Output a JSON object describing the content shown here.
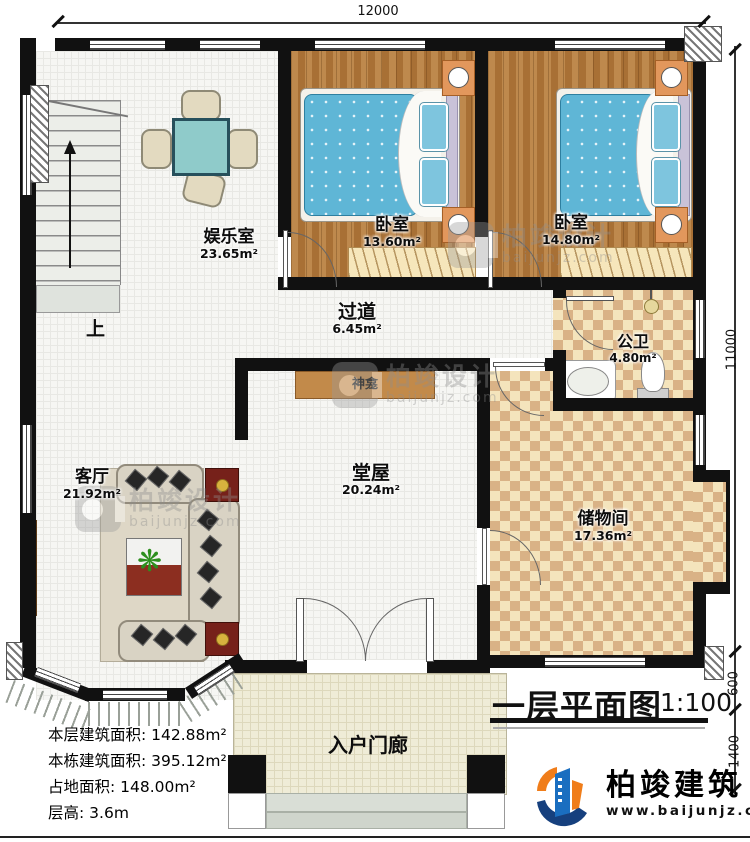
{
  "dimensions": {
    "top": "12000",
    "right_main": "11000",
    "right_mid": "600",
    "right_bottom": "1400"
  },
  "rooms": {
    "entertainment": {
      "name": "娱乐室",
      "area": "23.65m²"
    },
    "bedroom1": {
      "name": "卧室",
      "area": "13.60m²"
    },
    "bedroom2": {
      "name": "卧室",
      "area": "14.80m²"
    },
    "corridor": {
      "name": "过道",
      "area": "6.45m²"
    },
    "bathroom": {
      "name": "公卫",
      "area": "4.80m²"
    },
    "living": {
      "name": "客厅",
      "area": "21.92m²"
    },
    "hall": {
      "name": "堂屋",
      "area": "20.24m²"
    },
    "storage": {
      "name": "储物间",
      "area": "17.36m²"
    },
    "porch": {
      "name": "入户门廊"
    }
  },
  "annotations": {
    "stairs_up": "上",
    "shrine": "神龛"
  },
  "title_block": {
    "title": "一层平面图",
    "scale": "1:100"
  },
  "stats": [
    {
      "label": "本层建筑面积:",
      "value": "142.88m²"
    },
    {
      "label": "本栋建筑面积:",
      "value": "395.12m²"
    },
    {
      "label": "占地面积:",
      "value": "148.00m²"
    },
    {
      "label": "层高:",
      "value": "3.6m"
    }
  ],
  "branding": {
    "company": "柏竣建筑",
    "website": "www.baijunjz.com"
  },
  "watermark": {
    "brand": "柏竣设计",
    "site": "baijunjz.com"
  },
  "icons": {
    "plant": "❋"
  },
  "colors": {
    "wall": "#111111",
    "wood": "#b2783b",
    "checker_dark": "#d9b286",
    "checker_light": "#f4e4bc",
    "bed_blue": "#5fb6d6",
    "logo_blue": "#1a6ec0",
    "logo_orange": "#f07d1a"
  }
}
